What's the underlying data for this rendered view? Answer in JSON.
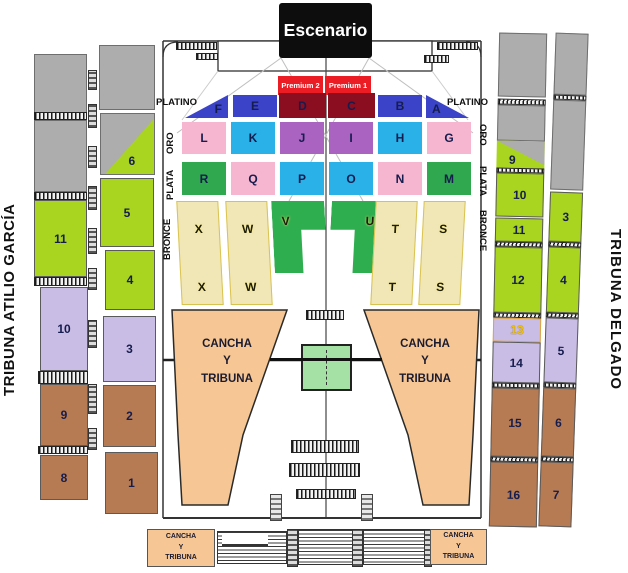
{
  "side_titles": {
    "left": "TRIBUNA ATILIO GARCÍA",
    "right": "TRIBUNA DELGADO"
  },
  "stage": {
    "label": "Escenario",
    "bg": "#0D0D0D",
    "fg": "#FFFFFF"
  },
  "premium": {
    "left": "Premium 2",
    "right": "Premium 1",
    "bg": "#EC1C24",
    "fg": "#FFFFFF"
  },
  "tiers": {
    "platino": {
      "label_left": "PLATINO",
      "label_right": "PLATINO",
      "sections": [
        {
          "l": "F",
          "c": "#3B43C8"
        },
        {
          "l": "E",
          "c": "#3B43C8"
        },
        {
          "l": "D",
          "c": "#8B0E20"
        },
        {
          "l": "C",
          "c": "#8B0E20"
        },
        {
          "l": "B",
          "c": "#3B43C8"
        },
        {
          "l": "A",
          "c": "#3B43C8"
        }
      ]
    },
    "oro": {
      "label_left": "ORO",
      "label_right": "ORO",
      "sections": [
        {
          "l": "L",
          "c": "#F7B6D0"
        },
        {
          "l": "K",
          "c": "#2AB1E8"
        },
        {
          "l": "J",
          "c": "#AB63C1"
        },
        {
          "l": "I",
          "c": "#AB63C1"
        },
        {
          "l": "H",
          "c": "#2AB1E8"
        },
        {
          "l": "G",
          "c": "#F7B6D0"
        }
      ]
    },
    "plata": {
      "label_left": "PLATA",
      "label_right": "PLATA",
      "sections": [
        {
          "l": "R",
          "c": "#2FA84F"
        },
        {
          "l": "Q",
          "c": "#F7B6D0"
        },
        {
          "l": "P",
          "c": "#2AB1E8"
        },
        {
          "l": "O",
          "c": "#2AB1E8"
        },
        {
          "l": "N",
          "c": "#F7B6D0"
        },
        {
          "l": "M",
          "c": "#2FA84F"
        }
      ]
    },
    "bronce": {
      "label_left": "BRONCE",
      "label_right": "BRONCE",
      "tan": "#F0E6B6",
      "green": "#2FAE50",
      "columns": [
        {
          "top": "X",
          "bottom": "X"
        },
        {
          "top": "W",
          "bottom": "W"
        },
        {
          "top": "V",
          "bottom": ""
        },
        {
          "top": "U",
          "bottom": ""
        },
        {
          "top": "T",
          "bottom": "T"
        },
        {
          "top": "S",
          "bottom": "S"
        }
      ]
    }
  },
  "cancha": {
    "label": "CANCHA\nY\nTRIBUNA",
    "c": "#F6C794"
  },
  "left_wing": {
    "outer": [
      {
        "l": "11",
        "c": "#A9D420"
      },
      {
        "l": "10",
        "c": "#CABDE5"
      },
      {
        "l": "9",
        "c": "#B67B52"
      },
      {
        "l": "8",
        "c": "#B67B52"
      }
    ],
    "inner": [
      {
        "l": "6",
        "c": "#A9D420"
      },
      {
        "l": "5",
        "c": "#A9D420"
      },
      {
        "l": "4",
        "c": "#A9D420"
      },
      {
        "l": "3",
        "c": "#CABDE5"
      },
      {
        "l": "2",
        "c": "#B67B52"
      },
      {
        "l": "1",
        "c": "#B67B52"
      }
    ]
  },
  "right_wing": {
    "inner": [
      {
        "l": "9",
        "c": "#A9D420"
      },
      {
        "l": "10",
        "c": "#A9D420"
      },
      {
        "l": "11",
        "c": "#A9D420"
      },
      {
        "l": "12",
        "c": "#A9D420"
      },
      {
        "l": "13",
        "c": "#CABDE5",
        "fg": "#F2C200"
      },
      {
        "l": "14",
        "c": "#CABDE5"
      },
      {
        "l": "15",
        "c": "#B67B52"
      },
      {
        "l": "16",
        "c": "#B67B52"
      }
    ],
    "outer": [
      {
        "l": "3",
        "c": "#A9D420"
      },
      {
        "l": "4",
        "c": "#A9D420"
      },
      {
        "l": "5",
        "c": "#CABDE5"
      },
      {
        "l": "6",
        "c": "#B67B52"
      },
      {
        "l": "7",
        "c": "#B67B52"
      }
    ]
  },
  "palette": {
    "gray_block": "#ADADAD",
    "outline": "#333333",
    "light_line": "#BFBFBF",
    "center_green_box": "#A5E0A5",
    "stage_black": "#0D0D0D",
    "red_premium": "#EC1C24",
    "yellow_13": "#F2C200"
  }
}
